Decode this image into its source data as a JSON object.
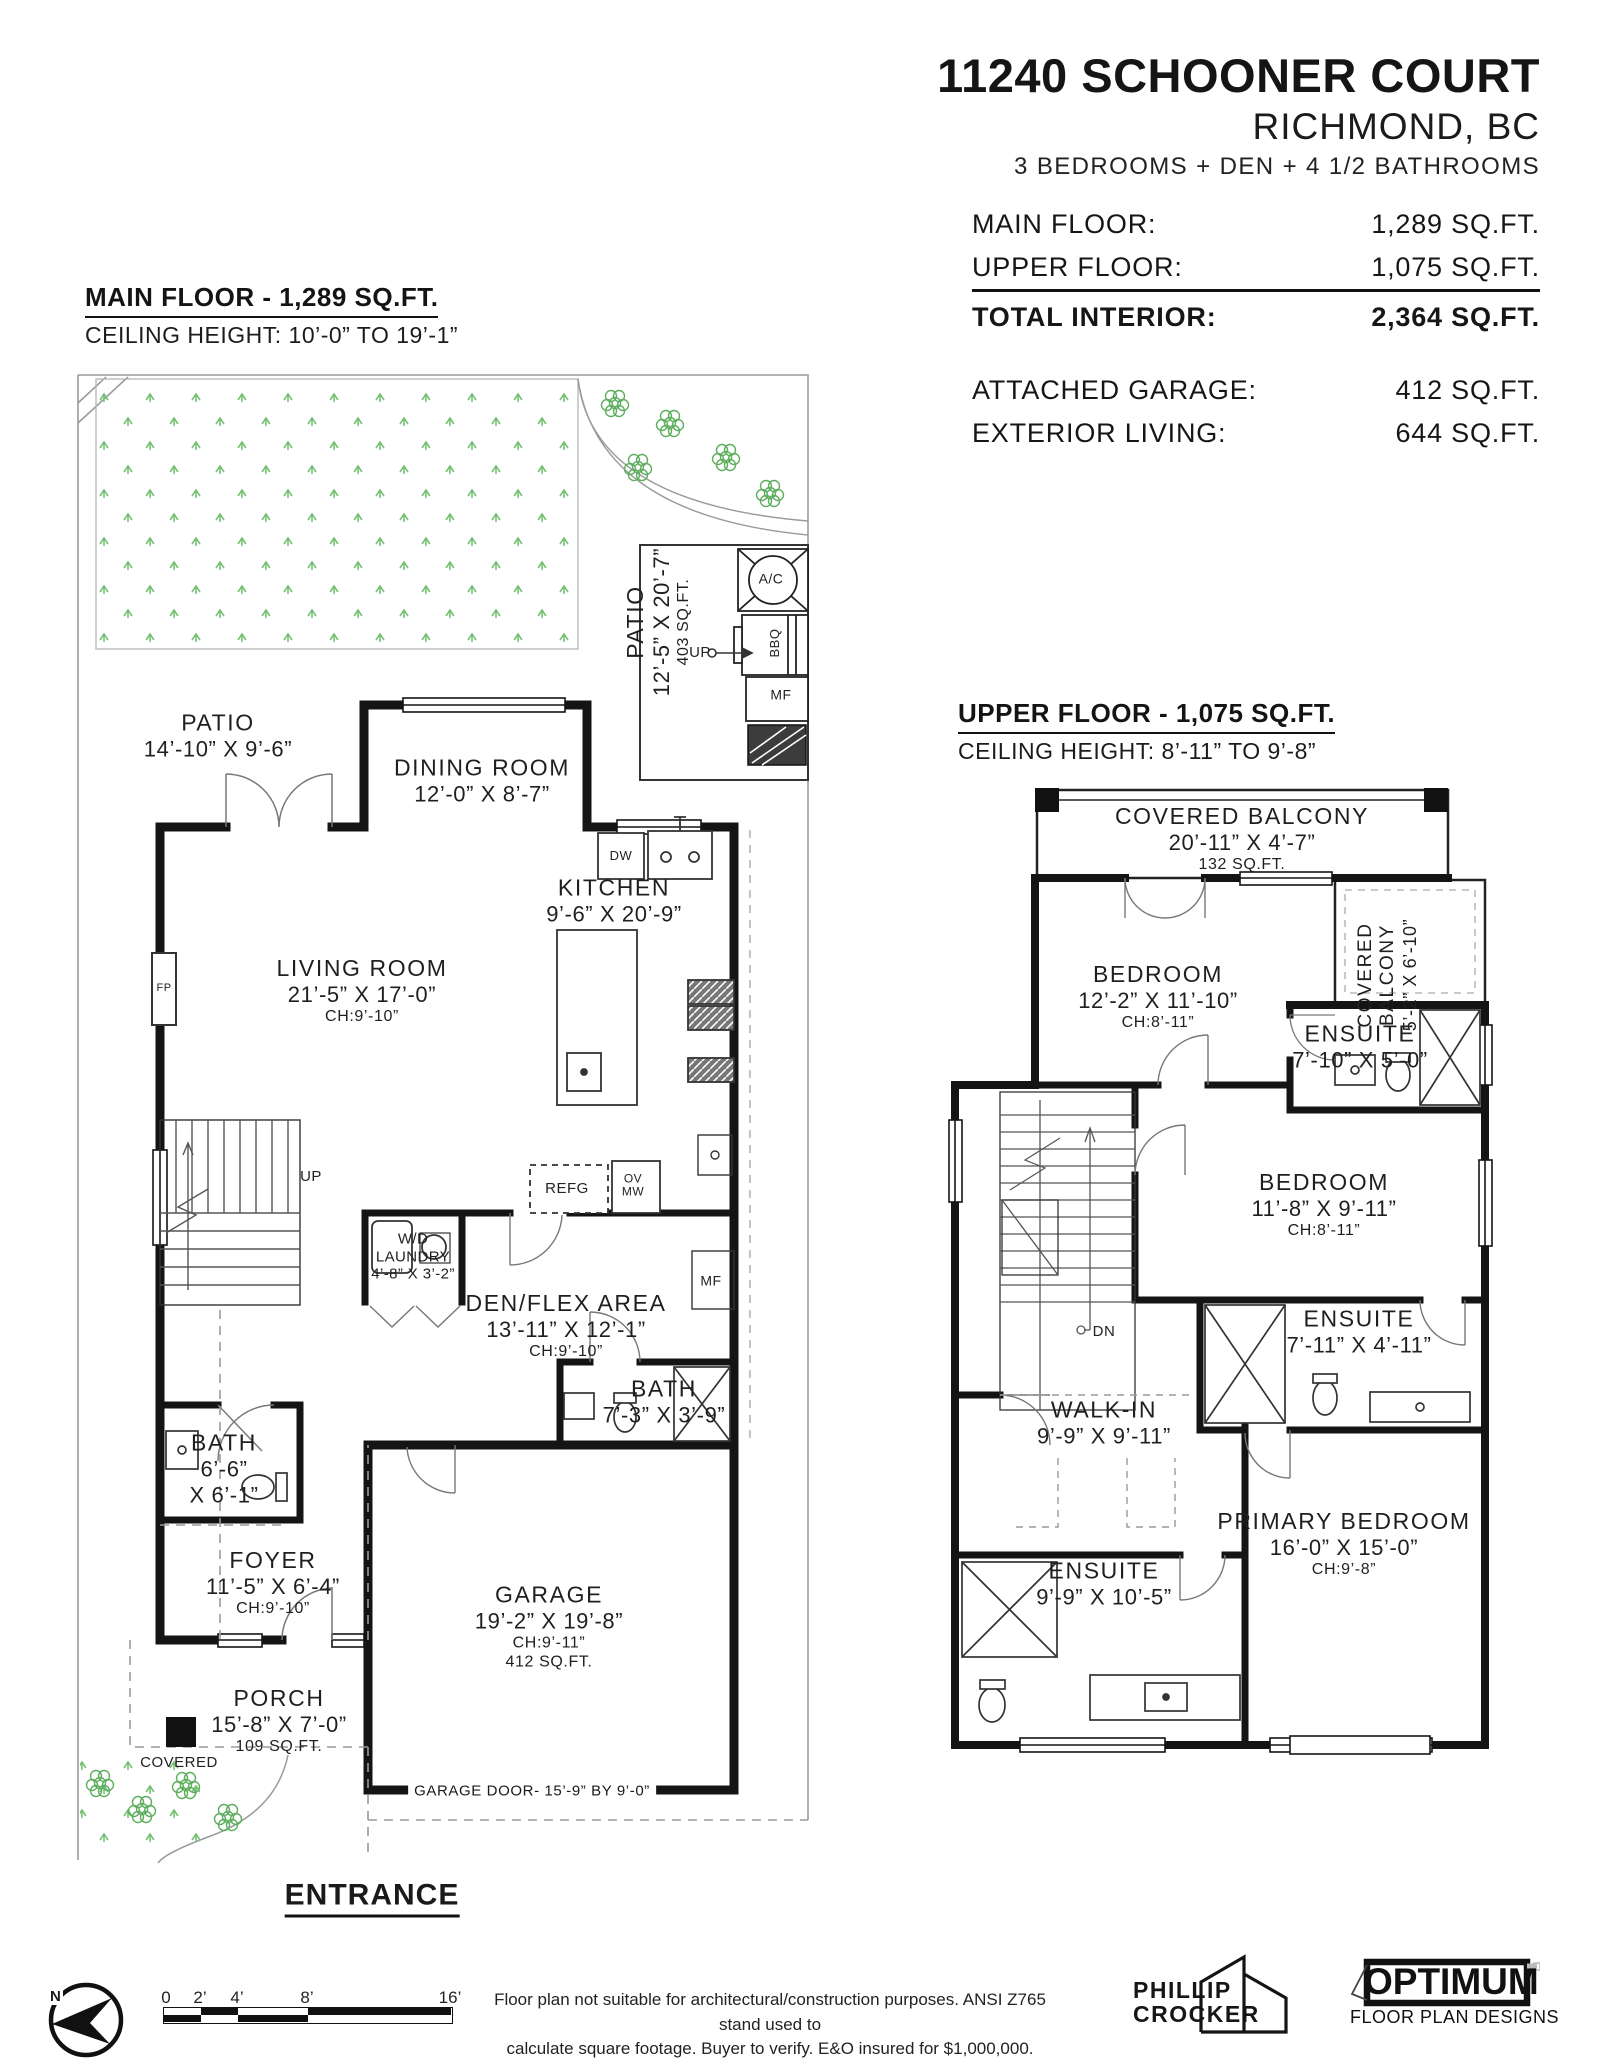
{
  "header": {
    "address": "11240 SCHOONER COURT",
    "city": "RICHMOND, BC",
    "summary": "3 BEDROOMS + DEN + 4 1/2 BATHROOMS",
    "rows": [
      {
        "label": "MAIN FLOOR:",
        "value": "1,289 SQ.FT."
      },
      {
        "label": "UPPER FLOOR:",
        "value": "1,075 SQ.FT."
      },
      {
        "label": "TOTAL INTERIOR:",
        "value": "2,364 SQ.FT."
      },
      {
        "label": "ATTACHED GARAGE:",
        "value": "412 SQ.FT."
      },
      {
        "label": "EXTERIOR LIVING:",
        "value": "644 SQ.FT."
      }
    ]
  },
  "main_floor": {
    "title": "MAIN FLOOR - 1,289 SQ.FT.",
    "ceiling": "CEILING HEIGHT: 10’-0” TO 19’-1”",
    "patio_right": {
      "name": "PATIO",
      "dims": "12’-5” X 20’-7”",
      "area": "403 SQ.FT."
    },
    "patio_left": {
      "name": "PATIO",
      "dims": "14’-10” X 9’-6”"
    },
    "dining": {
      "name": "DINING ROOM",
      "dims": "12’-0” X 8’-7”"
    },
    "kitchen": {
      "name": "KITCHEN",
      "dims": "9’-6” X 20’-9”"
    },
    "living": {
      "name": "LIVING ROOM",
      "dims": "21’-5” X 17’-0”",
      "ch": "CH:9’-10”"
    },
    "laundry": {
      "name1": "W/D",
      "name2": "LAUNDRY",
      "dims": "4’-8” X 3’-2”"
    },
    "den": {
      "name": "DEN/FLEX AREA",
      "dims": "13’-11” X 12’-1”",
      "ch": "CH:9’-10”"
    },
    "bath_den": {
      "name": "BATH",
      "dims": "7’-3” X 3’-9”"
    },
    "bath_main": {
      "name": "BATH",
      "dims1": "6’-6”",
      "dims2": "X 6’-1”"
    },
    "foyer": {
      "name": "FOYER",
      "dims": "11’-5” X 6’-4”",
      "ch": "CH:9’-10”"
    },
    "porch": {
      "name": "PORCH",
      "dims": "15’-8” X 7’-0”",
      "area": "109 SQ.FT."
    },
    "covered": "COVERED",
    "garage": {
      "name": "GARAGE",
      "dims": "19’-2” X 19’-8”",
      "ch": "CH:9’-11”",
      "area": "412 SQ.FT."
    },
    "garage_door": "GARAGE DOOR- 15’-9” BY 9’-0”",
    "entrance": "ENTRANCE",
    "labels": {
      "ac": "A/C",
      "bbq": "BBQ",
      "mf": "MF",
      "up": "UP",
      "dw": "DW",
      "refg": "REFG",
      "ov": "OV",
      "mw": "MW",
      "fp": "FP",
      "up2": "UP",
      "mf2": "MF"
    }
  },
  "upper_floor": {
    "title": "UPPER FLOOR - 1,075 SQ.FT.",
    "ceiling": "CEILING HEIGHT: 8’-11” TO 9’-8”",
    "balcony_top": {
      "name": "COVERED BALCONY",
      "dims": "20’-11” X 4’-7”",
      "area": "132 SQ.FT."
    },
    "balcony_side": {
      "line1": "COVERED",
      "line2": "BALCONY",
      "dims": "5’-2” X 6’-10”"
    },
    "bedroom1": {
      "name": "BEDROOM",
      "dims": "12’-2” X 11’-10”",
      "ch": "CH:8’-11”"
    },
    "ensuite1": {
      "name": "ENSUITE",
      "dims": "7’-10” X 5’-0”"
    },
    "bedroom2": {
      "name": "BEDROOM",
      "dims": "11’-8” X 9’-11”",
      "ch": "CH:8’-11”"
    },
    "ensuite2": {
      "name": "ENSUITE",
      "dims": "7’-11” X 4’-11”"
    },
    "walkin": {
      "name": "WALK-IN",
      "dims": "9’-9” X 9’-11”"
    },
    "primary": {
      "name": "PRIMARY BEDROOM",
      "dims": "16’-0” X 15’-0”",
      "ch": "CH:9’-8”"
    },
    "ensuite3": {
      "name": "ENSUITE",
      "dims": "9’-9” X 10’-5”"
    },
    "dn": "DN"
  },
  "footer": {
    "north": "N",
    "scale_ticks": [
      "0",
      "2’",
      "4’",
      "8’",
      "16’"
    ],
    "disclaimer1": "Floor plan not suitable for architectural/construction purposes. ANSI Z765 stand used to",
    "disclaimer2": "calculate square footage. Buyer to verify.  E&O insured for $1,000,000.",
    "credit1": "PHILLIP",
    "credit2": "CROCKER",
    "brand": "OPTIMUM",
    "brand_sub": "FLOOR PLAN DESIGNS"
  }
}
